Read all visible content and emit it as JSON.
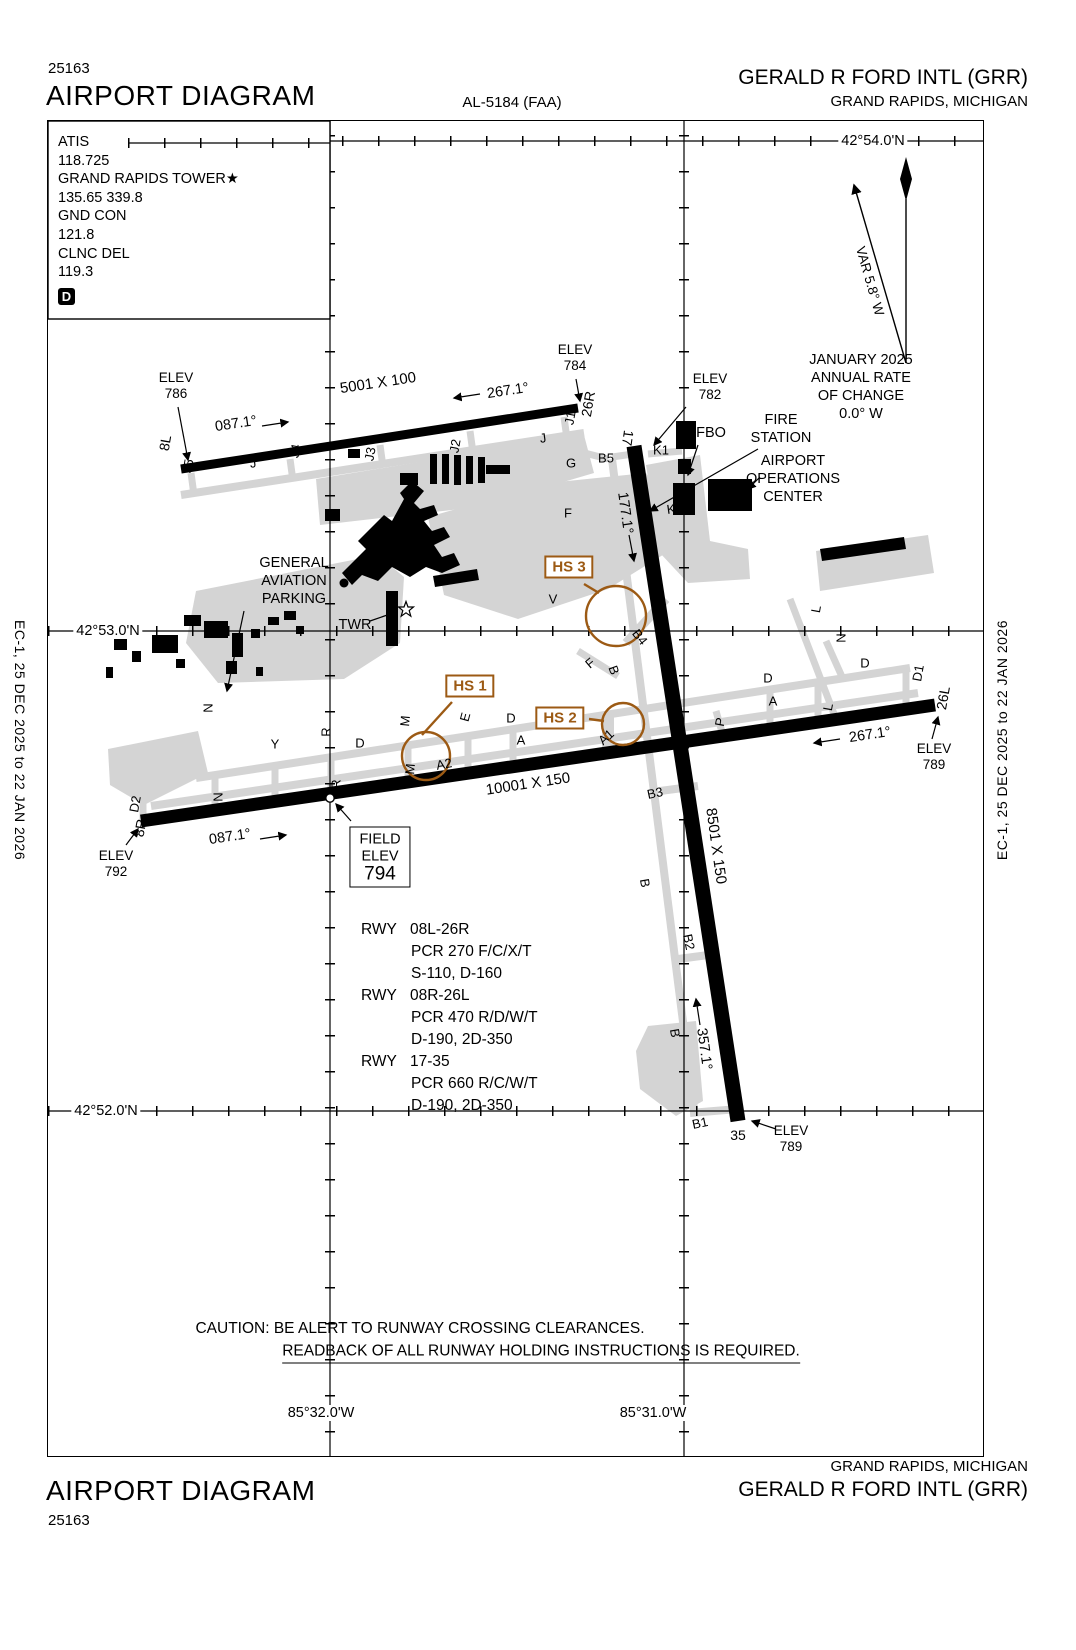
{
  "header": {
    "chart_number": "25163",
    "title": "AIRPORT DIAGRAM",
    "procedure_ref": "AL-5184 (FAA)",
    "airport": "GERALD R FORD INTL (GRR)",
    "city": "GRAND RAPIDS, MICHIGAN"
  },
  "footer": {
    "title": "AIRPORT DIAGRAM",
    "chart_number": "25163",
    "airport": "GERALD R FORD INTL (GRR)",
    "city": "GRAND RAPIDS, MICHIGAN"
  },
  "edge_note": "EC-1,  25 DEC 2025  to  22 JAN 2026",
  "comms": {
    "atis_label": "ATIS",
    "atis_freq": "118.725",
    "tower_label": "GRAND RAPIDS TOWER★",
    "tower_freq": "135.65 339.8",
    "ground_label": "GND CON",
    "ground_freq": "121.8",
    "clearance_label": "CLNC DEL",
    "clearance_freq": "119.3",
    "datis_symbol": "D"
  },
  "compass": {
    "variation": "VAR 5.8° W",
    "date": "JANUARY 2025",
    "rate1": "ANNUAL RATE OF CHANGE",
    "rate2": "0.0° W"
  },
  "graticule": {
    "lat_54": "42°54.0'N",
    "lat_53": "42°53.0'N",
    "lat_52": "42°52.0'N",
    "lon_32": "85°32.0'W",
    "lon_31": "85°31.0'W"
  },
  "runways": [
    {
      "id": "08L-26R",
      "end1": "8L",
      "end2": "26R",
      "dim": "5001 X 100",
      "hdg1": "087.1°",
      "hdg2": "267.1°",
      "elev_label": "ELEV",
      "end1_elev": "786",
      "end2_elev": "784"
    },
    {
      "id": "08R-26L",
      "end1": "8R",
      "end2": "26L",
      "dim": "10001 X 150",
      "hdg1": "087.1°",
      "hdg2": "267.1°",
      "elev_label": "ELEV",
      "end1_elev": "792",
      "end2_elev": "789"
    },
    {
      "id": "17-35",
      "end1": "17",
      "end2": "35",
      "dim": "8501 X 150",
      "hdg1": "177.1°",
      "hdg2": "357.1°",
      "elev_label": "ELEV",
      "end1_elev": "782",
      "end2_elev": "789"
    }
  ],
  "field_elev": {
    "line1": "FIELD",
    "line2": "ELEV",
    "value": "794"
  },
  "runway_data": {
    "label": "RWY",
    "rows": [
      {
        "rwy": "08L-26R",
        "pcr": "PCR 270 F/C/X/T",
        "gear": "S-110, D-160"
      },
      {
        "rwy": "08R-26L",
        "pcr": "PCR 470 R/D/W/T",
        "gear": "D-190, 2D-350"
      },
      {
        "rwy": "17-35",
        "pcr": "PCR 660 R/C/W/T",
        "gear": "D-190, 2D-350"
      }
    ]
  },
  "hotspots": [
    {
      "label": "HS 1"
    },
    {
      "label": "HS 2"
    },
    {
      "label": "HS 3"
    }
  ],
  "facilities": {
    "ga1": "GENERAL",
    "ga2": "AVIATION",
    "ga3": "PARKING",
    "tower": "TWR",
    "fbo": "FBO",
    "fire1": "FIRE",
    "fire2": "STATION",
    "ops1": "AIRPORT",
    "ops2": "OPERATIONS",
    "ops3": "CENTER"
  },
  "caution": {
    "line1": "CAUTION: BE ALERT TO RUNWAY CROSSING CLEARANCES.",
    "line2": "READBACK OF ALL RUNWAY HOLDING INSTRUCTIONS IS REQUIRED."
  },
  "taxiway_labels": [
    "J5",
    "J",
    "J4",
    "J3",
    "J2",
    "J1",
    "J",
    "G",
    "B5",
    "K1",
    "K",
    "F",
    "V",
    "B4",
    "F",
    "B",
    "M",
    "E",
    "D",
    "A",
    "A2",
    "M",
    "A1",
    "P",
    "B3",
    "B",
    "B2",
    "B",
    "B1",
    "D",
    "Y",
    "N",
    "N",
    "R",
    "R",
    "D2",
    "D",
    "D",
    "L",
    "L",
    "N",
    "A",
    "D1"
  ],
  "accent_color": "#9C5A14"
}
